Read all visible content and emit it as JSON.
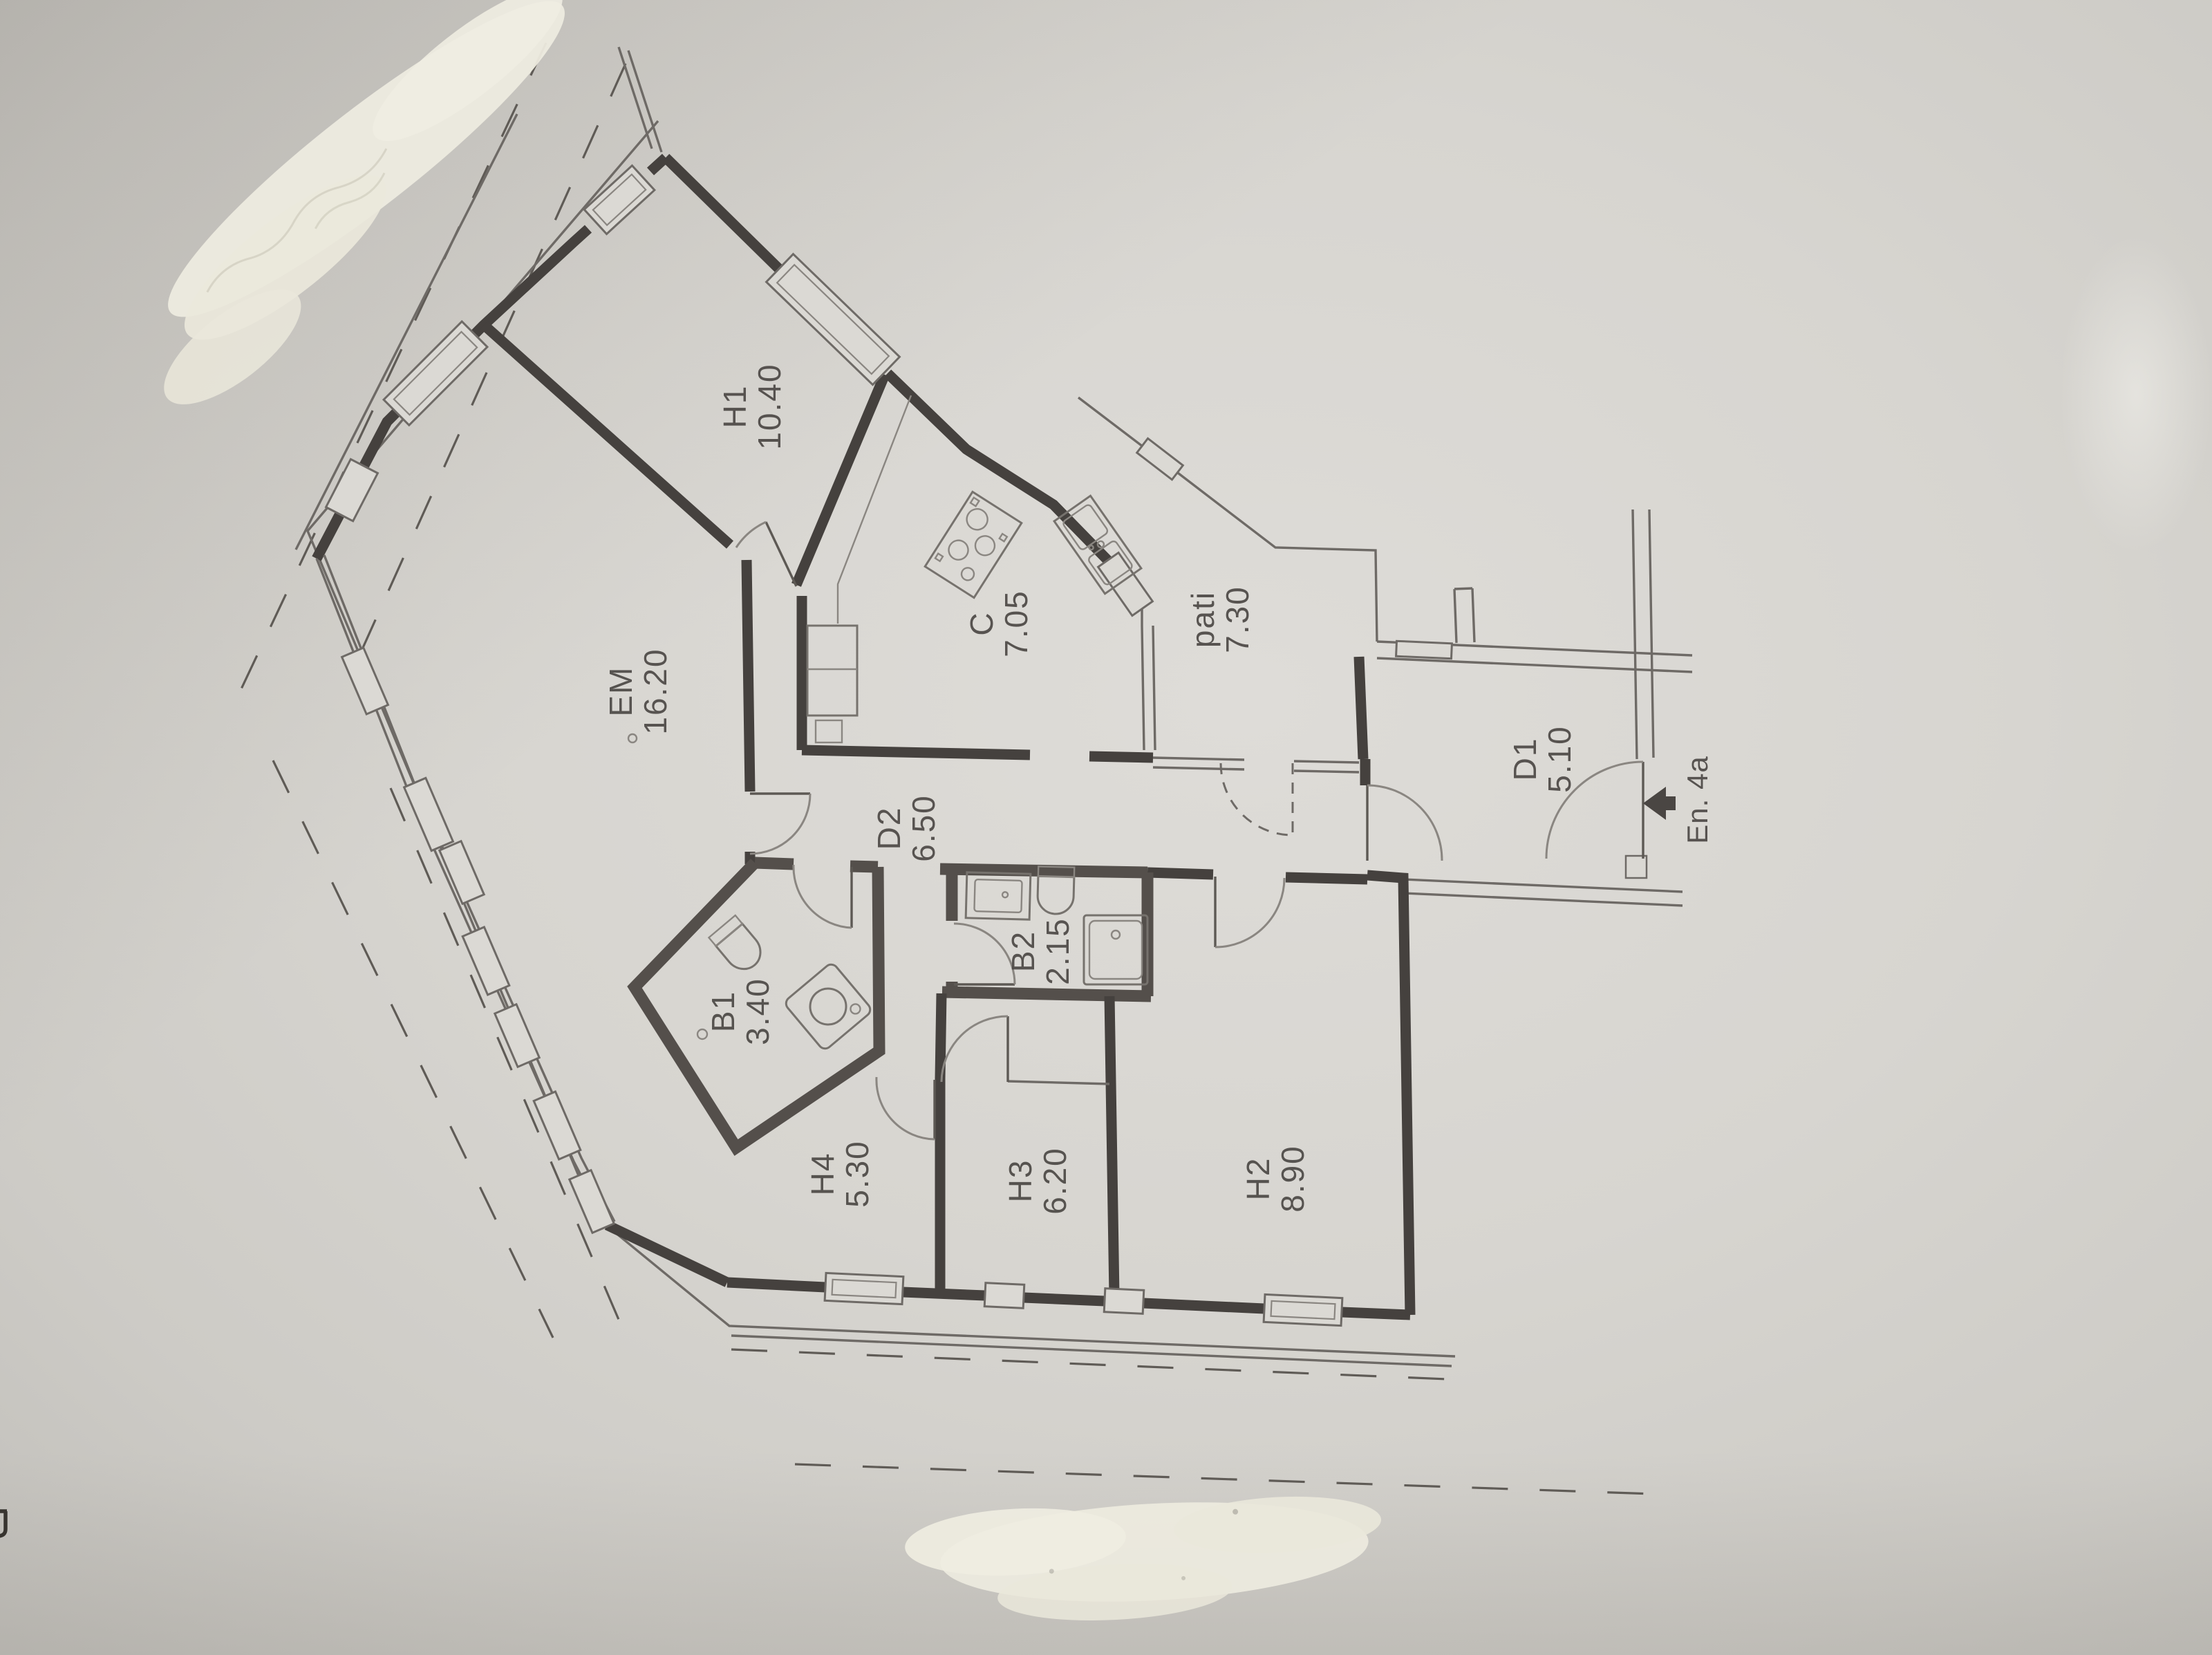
{
  "document": {
    "kind": "floor-plan-photo",
    "orientation": "labels rotated 90 degrees, read bottom-to-top"
  },
  "rooms": [
    {
      "code": "H1",
      "area": "10.40"
    },
    {
      "code": "EM",
      "area": "16.20"
    },
    {
      "code": "C",
      "area": "7.05"
    },
    {
      "code": "pati",
      "area": "7.30"
    },
    {
      "code": "D1",
      "area": "5.10"
    },
    {
      "code": "D2",
      "area": "6.50"
    },
    {
      "code": "B1",
      "area": "3.40"
    },
    {
      "code": "B2",
      "area": "2.15"
    },
    {
      "code": "H4",
      "area": "5.30"
    },
    {
      "code": "H3",
      "area": "6.20"
    },
    {
      "code": "H2",
      "area": "8.90"
    }
  ],
  "entrance": {
    "label": "En. 4a"
  },
  "colors": {
    "paper": "#d7d5d0",
    "ink": "#45413e",
    "label_ink": "#4c4845",
    "whiteout": "#edebdf"
  }
}
